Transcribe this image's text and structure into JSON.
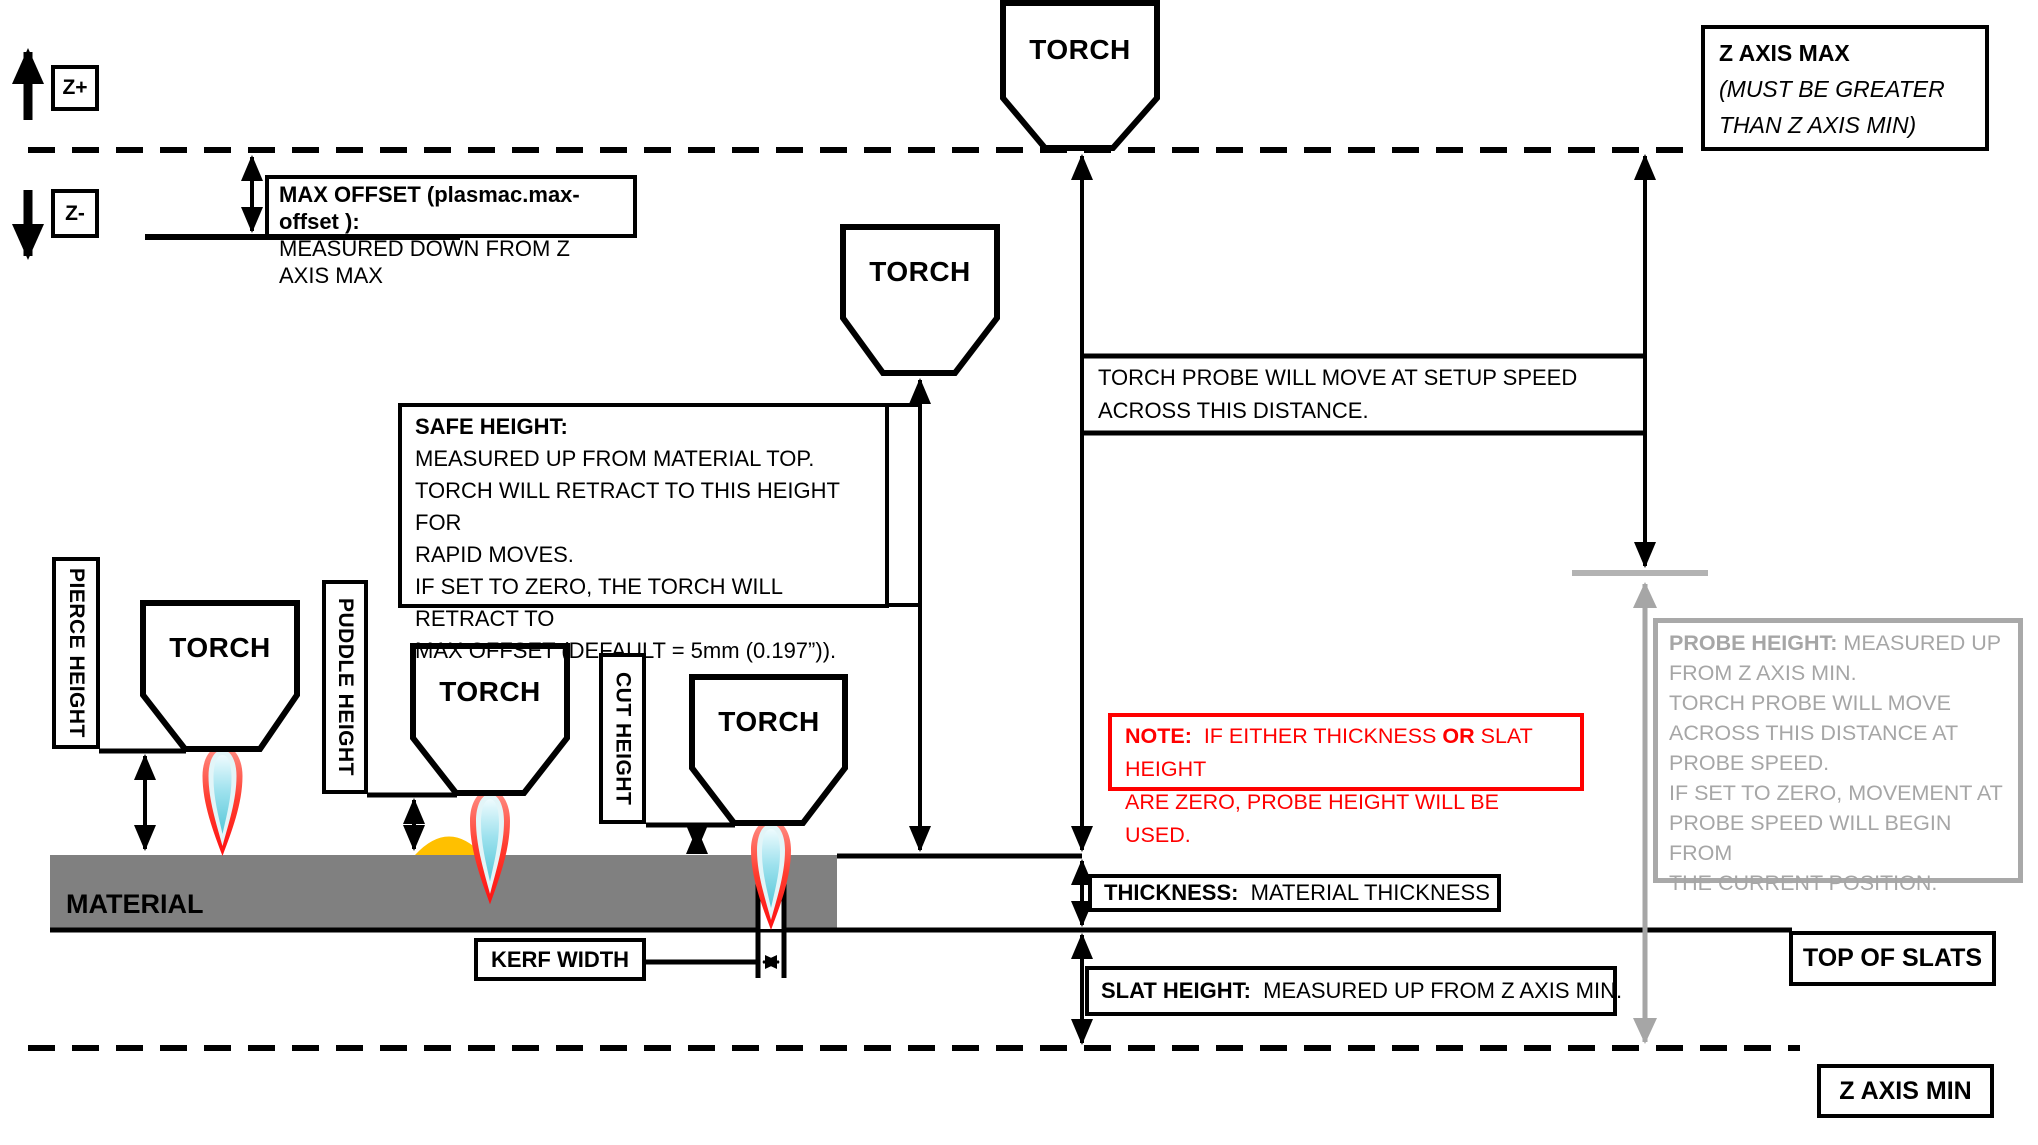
{
  "colors": {
    "line_black": "#000000",
    "material_gray": "#808080",
    "probe_gray": "#a6a6a6",
    "note_red": "#ff0000",
    "puddle_orange": "#ffc000",
    "flame_red": "#ff3322",
    "flame_cyan": "#56c7d8"
  },
  "labels": {
    "torch": "TORCH",
    "z_plus": "Z+",
    "z_minus": "Z-",
    "material": "MATERIAL",
    "pierce_height": "PIERCE HEIGHT",
    "puddle_height": "PUDDLE HEIGHT",
    "cut_height": "CUT HEIGHT",
    "kerf_width": "KERF WIDTH",
    "top_of_slats": "TOP OF SLATS",
    "z_axis_min": "Z AXIS MIN"
  },
  "max_offset": {
    "line1": "MAX OFFSET (plasmac.max-offset ):",
    "line2": "MEASURED DOWN FROM Z AXIS MAX"
  },
  "z_axis_max": {
    "line1": "Z AXIS MAX",
    "line2": "(MUST BE GREATER",
    "line3": "THAN Z AXIS MIN)"
  },
  "safe_height": {
    "line1": "SAFE HEIGHT:",
    "line2": "MEASURED UP FROM MATERIAL TOP.",
    "line3": "TORCH WILL RETRACT TO THIS HEIGHT FOR",
    "line4": "RAPID MOVES.",
    "line5": "IF SET TO ZERO, THE TORCH WILL RETRACT TO",
    "line6": "MAX OFFSET (DEFAULT = 5mm (0.197”))."
  },
  "torch_probe": {
    "line1": "TORCH PROBE WILL MOVE AT SETUP SPEED",
    "line2": "ACROSS THIS DISTANCE."
  },
  "probe_height": {
    "title": "PROBE HEIGHT:",
    "line1_rest": " MEASURED UP",
    "line2": "FROM Z AXIS MIN.",
    "line3": "TORCH PROBE WILL MOVE",
    "line4": "ACROSS THIS DISTANCE AT",
    "line5": "PROBE SPEED.",
    "line6": "IF SET TO ZERO,  MOVEMENT AT",
    "line7": "PROBE SPEED WILL BEGIN FROM",
    "line8": "THE CURRENT POSITION."
  },
  "note": {
    "bold1": "NOTE:",
    "seg1": "  IF EITHER THICKNESS ",
    "bold2": "OR",
    "seg2": " SLAT HEIGHT",
    "line2": "ARE ZERO, PROBE HEIGHT WILL BE USED."
  },
  "thickness": {
    "title": "THICKNESS:",
    "rest": "  MATERIAL THICKNESS"
  },
  "slat_height": {
    "title": "SLAT HEIGHT:",
    "rest": "  MEASURED UP FROM Z AXIS MIN."
  }
}
